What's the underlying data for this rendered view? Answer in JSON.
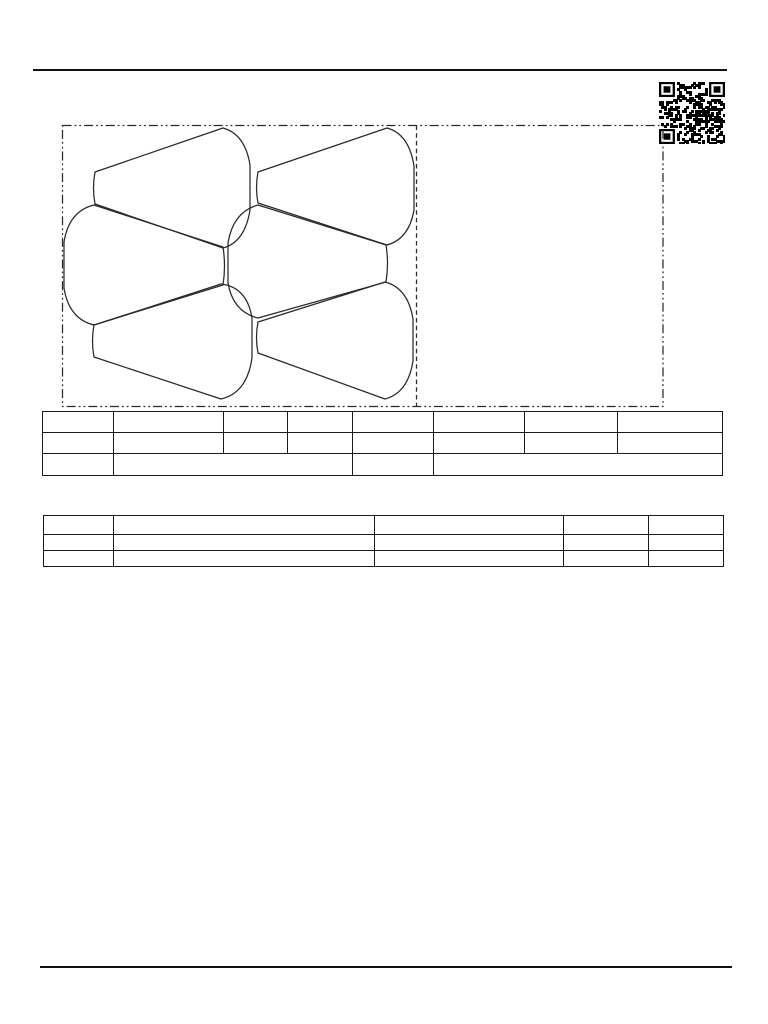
{
  "page": {
    "title": "pattern-template-sheet",
    "background": "#ffffff",
    "line_color": "#1f1f1f"
  },
  "top_rule": {
    "x": 33,
    "y": 68.5,
    "width": 694,
    "height": 2.6,
    "color": "#111111"
  },
  "bottom_rule": {
    "x": 40,
    "y": 966,
    "width": 692,
    "height": 2.4,
    "color": "#111111"
  },
  "qr_code": {
    "x": 659,
    "y": 82,
    "width": 66,
    "height": 62,
    "modules": 29,
    "dark": "#000000",
    "light": "#ffffff",
    "seed": 987654321
  },
  "pattern_layout": {
    "stroke": "#2a2a2a",
    "stroke_width": 1.25,
    "boundary_box": {
      "x": 62.5,
      "y": 125.5,
      "width": 600.5,
      "height": 281,
      "dash": "9 3 1.8 3 1.8 3"
    },
    "divider_line": {
      "x": 416.5,
      "y1": 125.5,
      "y2": 406.5,
      "dash": "4.5 3.2"
    },
    "pieces": [
      {
        "id": "piece-top-left",
        "d": "M95,172 L223,128 Q245,134 250,165 L250,210 Q245,242 223,248 L95,204 Q92,188 95,172 Z"
      },
      {
        "id": "piece-top-right",
        "d": "M258,172 L387,128 Q409,134 414,166 L414,210 Q409,239 387,245 L258,203 Q255,187.5 258,172 Z"
      },
      {
        "id": "piece-middle-left",
        "d": "M223,247 L94,205 Q69,211 64,242 L64,288 Q69,319 94,325 L223,285 Q226,266 223,247 Z"
      },
      {
        "id": "piece-middle-right",
        "d": "M386,245 L258,205 Q233,212 228,243 L228,283 Q233,312 258,318 L386,282 Q389,263.5 386,245 Z"
      },
      {
        "id": "piece-bottom-left",
        "d": "M94,325 L221,284 Q247,287 252,318 L252,358 Q247,393 221,399 L94,357 Q91,341 94,325 Z"
      },
      {
        "id": "piece-bottom-right",
        "d": "M258,322 L385,282 Q408,288 413,319 L413,361 Q408,393 385,399 L258,353 Q255,337.5 258,322 Z"
      }
    ]
  },
  "tables": [
    {
      "id": "spec-table-upper",
      "x": 42,
      "y": 411,
      "width": 680,
      "col_widths": [
        71,
        110,
        64,
        65,
        81,
        91,
        93,
        105
      ],
      "rows": [
        {
          "height": 21,
          "cells": [
            {
              "span": 1,
              "text": ""
            },
            {
              "span": 1,
              "text": ""
            },
            {
              "span": 1,
              "text": ""
            },
            {
              "span": 1,
              "text": ""
            },
            {
              "span": 1,
              "text": ""
            },
            {
              "span": 1,
              "text": ""
            },
            {
              "span": 1,
              "text": ""
            },
            {
              "span": 1,
              "text": ""
            }
          ]
        },
        {
          "height": 21,
          "cells": [
            {
              "span": 1,
              "text": ""
            },
            {
              "span": 1,
              "text": ""
            },
            {
              "span": 1,
              "text": ""
            },
            {
              "span": 1,
              "text": ""
            },
            {
              "span": 1,
              "text": ""
            },
            {
              "span": 1,
              "text": ""
            },
            {
              "span": 1,
              "text": ""
            },
            {
              "span": 1,
              "text": ""
            }
          ]
        },
        {
          "height": 22,
          "cells": [
            {
              "span": 1,
              "text": ""
            },
            {
              "span": 3,
              "text": ""
            },
            {
              "span": 1,
              "text": ""
            },
            {
              "span": 3,
              "text": ""
            }
          ]
        }
      ]
    },
    {
      "id": "spec-table-lower",
      "x": 43,
      "y": 515,
      "width": 680,
      "col_widths": [
        70,
        261,
        189,
        85,
        75
      ],
      "rows": [
        {
          "height": 19,
          "cells": [
            {
              "span": 1,
              "text": ""
            },
            {
              "span": 1,
              "text": ""
            },
            {
              "span": 1,
              "text": ""
            },
            {
              "span": 1,
              "text": ""
            },
            {
              "span": 1,
              "text": ""
            }
          ]
        },
        {
          "height": 16,
          "cells": [
            {
              "span": 1,
              "text": ""
            },
            {
              "span": 1,
              "text": ""
            },
            {
              "span": 1,
              "text": ""
            },
            {
              "span": 1,
              "text": ""
            },
            {
              "span": 1,
              "text": ""
            }
          ]
        },
        {
          "height": 16,
          "cells": [
            {
              "span": 1,
              "text": ""
            },
            {
              "span": 1,
              "text": ""
            },
            {
              "span": 1,
              "text": ""
            },
            {
              "span": 1,
              "text": ""
            },
            {
              "span": 1,
              "text": ""
            }
          ]
        }
      ]
    }
  ]
}
